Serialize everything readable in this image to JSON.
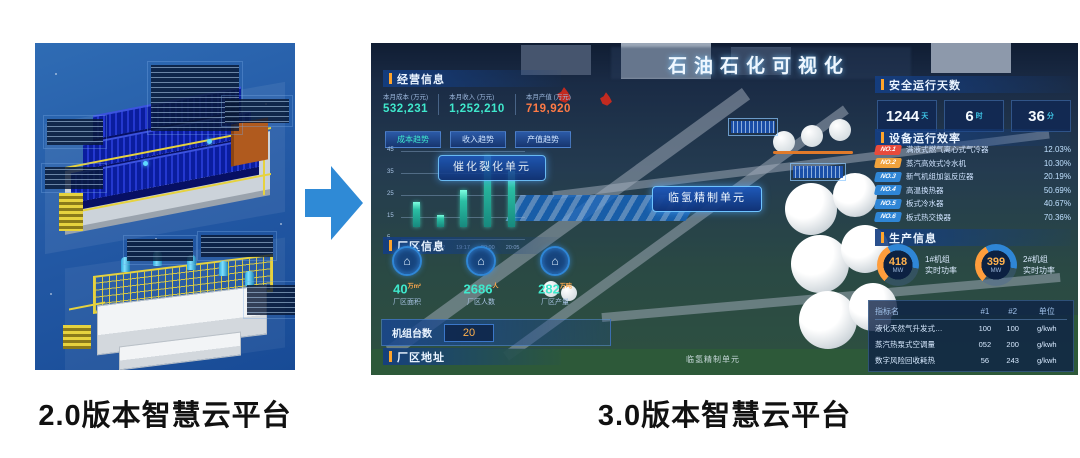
{
  "left_figure": {
    "caption": "2.0版本智慧云平台"
  },
  "arrow": {
    "color": "#2f8ad6"
  },
  "dashboard": {
    "caption": "3.0版本智慧云平台",
    "title": "石油石化可视化",
    "business": {
      "header": "经营信息",
      "stats": [
        {
          "label": "本月成本 (万元)",
          "value": "532,231",
          "color": "#3fe8cc"
        },
        {
          "label": "本月收入 (万元)",
          "value": "1,252,210",
          "color": "#3fe8cc"
        },
        {
          "label": "本月产值 (万元)",
          "value": "719,920",
          "color": "#ff7a45"
        }
      ],
      "tabs": [
        "成本趋势",
        "收入趋势",
        "产值趋势"
      ]
    },
    "plant_info": {
      "header": "厂区信息",
      "stats": [
        {
          "value": "40",
          "unit": "万m²",
          "label": "厂区面积"
        },
        {
          "value": "2686",
          "unit": "人",
          "label": "厂区人数"
        },
        {
          "value": "282",
          "unit": "万吨",
          "label": "厂区产量"
        }
      ]
    },
    "units_count": {
      "label": "机组台数",
      "value": "20"
    },
    "plant_address": {
      "header": "厂区地址"
    },
    "safe_days": {
      "header": "安全运行天数",
      "items": [
        {
          "value": "1244",
          "unit": "天"
        },
        {
          "value": "6",
          "unit": "时"
        },
        {
          "value": "36",
          "unit": "分"
        }
      ]
    },
    "equipment": {
      "header": "设备运行效率",
      "rows": [
        {
          "no": "NO.1",
          "name": "满液式燃气离心式气冷器",
          "value": "12.03%",
          "badge": "#e84b3c"
        },
        {
          "no": "NO.2",
          "name": "蒸汽高效式冷水机",
          "value": "10.30%",
          "badge": "#f0a23c"
        },
        {
          "no": "NO.3",
          "name": "新气机组加氢反应器",
          "value": "20.19%",
          "badge": "#2f86d6"
        },
        {
          "no": "NO.4",
          "name": "高温换热器",
          "value": "50.69%",
          "badge": "#2f86d6"
        },
        {
          "no": "NO.5",
          "name": "板式冷水器",
          "value": "40.67%",
          "badge": "#2f86d6"
        },
        {
          "no": "NO.6",
          "name": "板式热交换器",
          "value": "70.36%",
          "badge": "#2f86d6"
        }
      ]
    },
    "production": {
      "header": "生产信息",
      "gauges": [
        {
          "value": "418",
          "unit": "MW",
          "label1": "1#机组",
          "label2": "实时功率"
        },
        {
          "value": "399",
          "unit": "MW",
          "label1": "2#机组",
          "label2": "实时功率"
        }
      ],
      "table": {
        "headers": [
          "指标名",
          "#1",
          "#2",
          "单位"
        ],
        "rows": [
          [
            "液化天然气升发式…",
            "100",
            "100",
            "g/kwh"
          ],
          [
            "蒸汽热泵式空调量",
            "052",
            "200",
            "g/kwh"
          ],
          [
            "数字风险回收耗热",
            "56",
            "243",
            "g/kwh"
          ]
        ]
      }
    },
    "map_labels": {
      "hydro_refining": "临氢精制单元",
      "catalytic_cracking": "催化裂化单元",
      "bottom_unit": "临氢精制单元"
    }
  },
  "chart_data": {
    "type": "bar",
    "categories": [
      "19:08",
      "19:12",
      "19:17",
      "20:00",
      "20:05"
    ],
    "values": [
      15,
      7,
      22,
      42,
      33
    ],
    "title": "",
    "xlabel": "",
    "ylabel": "",
    "ylim": [
      0,
      45
    ],
    "yticks": [
      45,
      35,
      25,
      15,
      5
    ],
    "grid": true,
    "legend": false,
    "bar_color": "#35e0c8"
  }
}
